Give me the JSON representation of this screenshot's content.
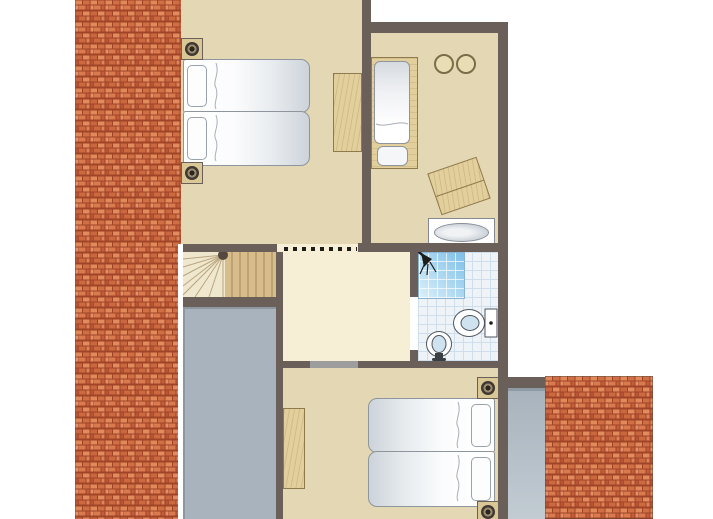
{
  "plan": {
    "kind": "residential-floor-plan",
    "visible_text": [],
    "rooms": [
      {
        "id": "bedroom-top-left",
        "furniture": [
          "twin-single-beds",
          "desk",
          "spotlight",
          "spotlight"
        ]
      },
      {
        "id": "bedroom-top-right",
        "furniture": [
          "framed-single-bed",
          "two-round-stools",
          "tilted-chest",
          "bathtub"
        ]
      },
      {
        "id": "bathroom",
        "furniture": [
          "shower",
          "toilet",
          "washbasin"
        ],
        "floor": "tiles"
      },
      {
        "id": "landing",
        "furniture": [
          "winder-stairs"
        ],
        "markers": [
          "dashed-clearance-line"
        ]
      },
      {
        "id": "bedroom-bottom",
        "furniture": [
          "double-bed",
          "desk",
          "spotlight",
          "spotlight"
        ]
      }
    ],
    "exterior": [
      "roof-tiles-left",
      "roof-tiles-bottom-right",
      "gray-void-left",
      "gray-strip-bottom-right"
    ]
  },
  "colors": {
    "outside": "#ffffff",
    "wall": "#6b6059",
    "floor": "#e4d8b4",
    "landing": "#f6efd5",
    "void_gray": "#a8b3bd",
    "gray_strip_top": "#8e9aa6",
    "wood": "#e3cf9b",
    "wood_dark": "#8f7a4e",
    "stair_wood": "#d8bc8a",
    "stair_light": "#f0e7cf",
    "tile_bg": "#eef3f8",
    "tile_line": "#cfdeec",
    "shower_from": "#7fc0e8",
    "shower_to": "#dcf0fa",
    "mattress_edge": "#ccd3da",
    "fixture_outline": "#4e565e",
    "fixture_fill": "#cfe2f0",
    "spot_plate": "#d9c795",
    "door_opening": "#9d9d9d",
    "dash": "#1d1d1b",
    "brick_mortar": "#a04428",
    "brick_tile_1": "#e08a5c",
    "brick_tile_2": "#cf6f45",
    "brick_tile_3": "#d97b4f",
    "brick_tile_4": "#c25e3a"
  },
  "counts": {
    "spotlights": 4,
    "single_beds": 5,
    "stools": 2
  }
}
